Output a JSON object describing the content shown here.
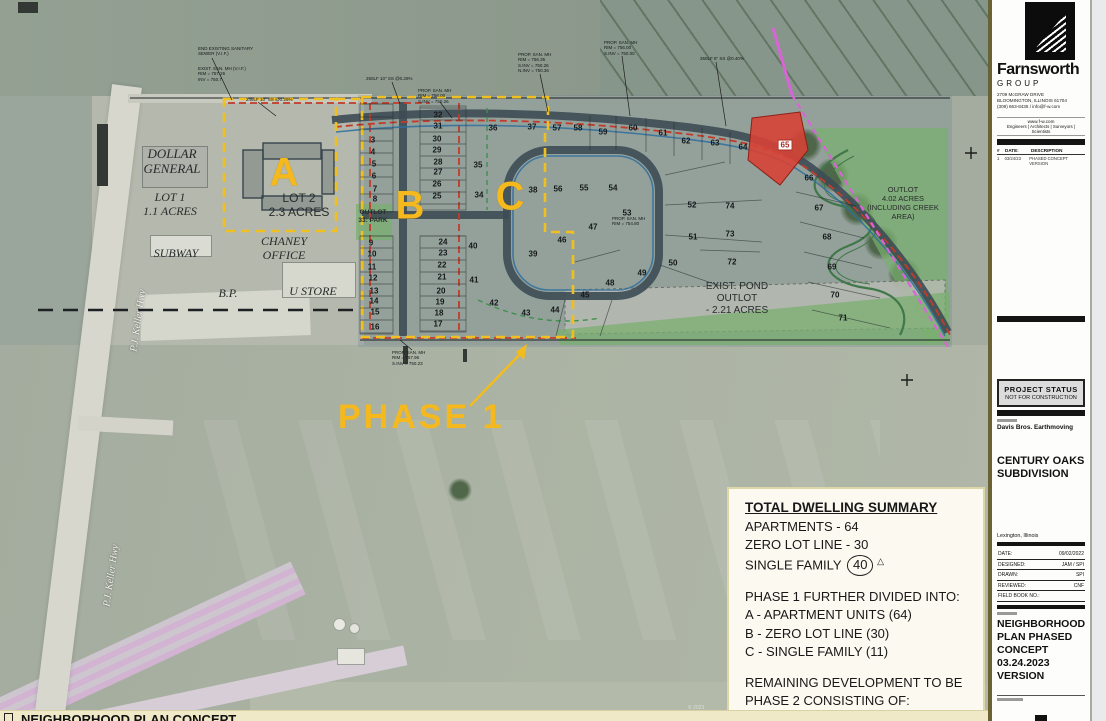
{
  "colors": {
    "phase_yellow": "#f2bc1f",
    "watermain_red": "#c23b2a",
    "street_dark": "#3d4b54",
    "outlot_green": "#78af6e",
    "forcemain_magenta": "#d964d8",
    "parcel_red": "#d64236"
  },
  "footer": {
    "label": "NEIGHBORHOOD PLAN CONCEPT"
  },
  "credit": "© 2023",
  "titleblock": {
    "firm": {
      "name": "Farnsworth",
      "group": "GROUP",
      "address_lines": [
        "2709 McGRAW DRIVE",
        "BLOOMINGTON, ILLINOIS  61704",
        "(309) 663-8435 / info@f-w.com"
      ],
      "website": "www.f-w.com",
      "disciplines": "Engineers | Architects | Surveyors | Scientists"
    },
    "revisions": {
      "header": {
        "num": "#",
        "date": "DATE:",
        "desc": "DESCRIPTION"
      },
      "rows": [
        {
          "num": "1",
          "date": "03/24/23",
          "desc": "PHASED CONCEPT VERSION"
        }
      ]
    },
    "status_box": {
      "line1": "PROJECT STATUS",
      "line2": "NOT FOR CONSTRUCTION"
    },
    "client": "Davis Bros. Earthmoving",
    "project": "CENTURY OAKS SUBDIVISION",
    "location": "Lexington, Illinois",
    "info_rows": [
      [
        "DATE:",
        "09/02/2022"
      ],
      [
        "DESIGNED:",
        "JAM / SPI"
      ],
      [
        "DRAWN:",
        "SPI"
      ],
      [
        "REVIEWED:",
        "CNF"
      ],
      [
        "FIELD BOOK NO.:",
        ""
      ]
    ],
    "sheet_title": "NEIGHBORHOOD PLAN PHASED CONCEPT 03.24.2023 VERSION"
  },
  "summary": {
    "title": "TOTAL DWELLING SUMMARY",
    "lines": [
      "APARTMENTS - 64",
      "ZERO LOT LINE - 30"
    ],
    "single_family_prefix": "SINGLE FAMILY",
    "single_family_value": "40",
    "single_family_delta": "△",
    "phase1_header": "PHASE 1 FURTHER DIVIDED INTO:",
    "phase1_items": [
      "A - APARTMENT UNITS (64)",
      "B - ZERO LOT LINE (30)",
      "C - SINGLE FAMILY (11)"
    ],
    "phase2_header": [
      "REMAINING DEVELOPMENT TO BE",
      "PHASE 2 CONSISTING OF:"
    ],
    "phase2_items": [
      "REMAINING SINGLE FAMILY (29)",
      "PUMP STATION &  FORCEMAIN"
    ]
  },
  "plan": {
    "phase_label": "PHASE 1",
    "zone_labels": [
      {
        "t": "A",
        "x": 284,
        "y": 173
      },
      {
        "t": "B",
        "x": 410,
        "y": 206
      },
      {
        "t": "C",
        "x": 510,
        "y": 197
      }
    ],
    "road_labels": [
      {
        "t": "P.J. Keller Hwy",
        "x": 107,
        "y": 315
      },
      {
        "t": "P.J. Keller Hwy",
        "x": 80,
        "y": 570
      }
    ],
    "area_labels": [
      {
        "lines": [
          "DOLLAR",
          "GENERAL"
        ],
        "x": 172,
        "y": 146,
        "fs": 13,
        "it": true
      },
      {
        "lines": [
          "LOT 1",
          "1.1 ACRES"
        ],
        "x": 170,
        "y": 190,
        "fs": 12,
        "it": true
      },
      {
        "lines": [
          "SUBWAY"
        ],
        "x": 176,
        "y": 246,
        "fs": 12,
        "it": true
      },
      {
        "lines": [
          "CHANEY",
          "OFFICE"
        ],
        "x": 284,
        "y": 234,
        "fs": 12,
        "it": true
      },
      {
        "lines": [
          "B.P."
        ],
        "x": 228,
        "y": 286,
        "fs": 12,
        "it": true
      },
      {
        "lines": [
          "U STORE"
        ],
        "x": 313,
        "y": 284,
        "fs": 12,
        "it": true
      },
      {
        "lines": [
          "LOT 2",
          "2.3 ACRES"
        ],
        "x": 299,
        "y": 191,
        "fs": 12,
        "it": false
      },
      {
        "lines": [
          "OUTLOT",
          "33: PARK"
        ],
        "x": 373,
        "y": 209,
        "fs": 6.5,
        "it": false,
        "bold": true
      },
      {
        "lines": [
          "EXIST. POND",
          "OUTLOT",
          "- 2.21 ACRES"
        ],
        "x": 737,
        "y": 281,
        "fs": 10,
        "it": false
      },
      {
        "lines": [
          "OUTLOT",
          "4.02 ACRES",
          "(INCLUDING CREEK",
          "AREA)"
        ],
        "x": 903,
        "y": 186,
        "fs": 7.5,
        "it": false
      }
    ],
    "lots": [
      [
        3,
        373,
        140
      ],
      [
        4,
        373,
        152
      ],
      [
        5,
        374,
        164
      ],
      [
        6,
        374,
        176
      ],
      [
        7,
        375,
        189
      ],
      [
        8,
        375,
        199
      ],
      [
        9,
        371,
        243
      ],
      [
        10,
        372,
        254
      ],
      [
        11,
        372,
        267
      ],
      [
        12,
        373,
        278
      ],
      [
        13,
        374,
        291
      ],
      [
        14,
        374,
        301
      ],
      [
        15,
        375,
        312
      ],
      [
        16,
        375,
        327
      ],
      [
        17,
        438,
        324
      ],
      [
        18,
        439,
        313
      ],
      [
        19,
        440,
        302
      ],
      [
        20,
        441,
        291
      ],
      [
        21,
        442,
        277
      ],
      [
        22,
        442,
        265
      ],
      [
        23,
        443,
        253
      ],
      [
        24,
        443,
        242
      ],
      [
        25,
        437,
        196
      ],
      [
        26,
        437,
        184
      ],
      [
        27,
        438,
        172
      ],
      [
        28,
        438,
        162
      ],
      [
        29,
        437,
        150
      ],
      [
        30,
        437,
        139
      ],
      [
        31,
        438,
        126
      ],
      [
        32,
        438,
        115
      ],
      [
        34,
        479,
        195
      ],
      [
        35,
        478,
        165
      ],
      [
        36,
        493,
        128
      ],
      [
        37,
        532,
        127
      ],
      [
        38,
        533,
        190
      ],
      [
        39,
        533,
        254
      ],
      [
        40,
        473,
        246
      ],
      [
        41,
        474,
        280
      ],
      [
        42,
        494,
        303
      ],
      [
        43,
        526,
        313
      ],
      [
        44,
        555,
        310
      ],
      [
        45,
        585,
        295
      ],
      [
        46,
        562,
        240
      ],
      [
        47,
        593,
        227
      ],
      [
        48,
        610,
        283
      ],
      [
        49,
        642,
        273
      ],
      [
        50,
        673,
        263
      ],
      [
        51,
        693,
        237
      ],
      [
        52,
        692,
        205
      ],
      [
        53,
        627,
        213
      ],
      [
        54,
        613,
        188
      ],
      [
        55,
        584,
        188
      ],
      [
        56,
        558,
        189
      ],
      [
        57,
        557,
        128
      ],
      [
        58,
        578,
        128
      ],
      [
        59,
        603,
        132
      ],
      [
        60,
        633,
        128
      ],
      [
        61,
        663,
        133
      ],
      [
        62,
        686,
        141
      ],
      [
        63,
        715,
        143
      ],
      [
        64,
        743,
        147
      ],
      [
        65,
        785,
        145,
        1
      ],
      [
        66,
        809,
        178
      ],
      [
        67,
        819,
        208
      ],
      [
        68,
        827,
        237
      ],
      [
        69,
        832,
        267
      ],
      [
        70,
        835,
        295
      ],
      [
        71,
        843,
        318
      ],
      [
        72,
        732,
        262
      ],
      [
        73,
        730,
        234
      ],
      [
        74,
        730,
        206
      ]
    ],
    "callouts": [
      {
        "x": 198,
        "y": 46,
        "lines": [
          "END EXISTING SANITARY",
          "SEWER (V.I.F.)"
        ]
      },
      {
        "x": 198,
        "y": 66,
        "lines": [
          "EXIST. SAN. MH (V.I.F.)",
          "RIM = 757.26",
          "INV = 750.7"
        ]
      },
      {
        "x": 246,
        "y": 97,
        "lines": [
          "246LF 10\" SS @0.28%"
        ]
      },
      {
        "x": 366,
        "y": 76,
        "lines": [
          "250LF 10\" SS @0.28%"
        ]
      },
      {
        "x": 418,
        "y": 88,
        "lines": [
          "PROP. SAN. MH",
          "RIM = 758.00",
          "S.INV = 750.26"
        ]
      },
      {
        "x": 518,
        "y": 52,
        "lines": [
          "PROP. SAN. MH",
          "RIM = 756.35",
          "S.INV = 750.26",
          "N.INV = 750.36"
        ]
      },
      {
        "x": 604,
        "y": 40,
        "lines": [
          "PROP. SAN. MH",
          "RIM = 756.00",
          "S.INV = 750.00"
        ]
      },
      {
        "x": 700,
        "y": 56,
        "lines": [
          "350LF 8\" SS @0.40%"
        ]
      },
      {
        "x": 392,
        "y": 350,
        "lines": [
          "PROP. SAN. MH",
          "RIM = 757.96",
          "S.INV = 750.23"
        ]
      },
      {
        "x": 612,
        "y": 216,
        "lines": [
          "PROP. SAN. MH",
          "RIM = 754.80"
        ]
      }
    ]
  }
}
